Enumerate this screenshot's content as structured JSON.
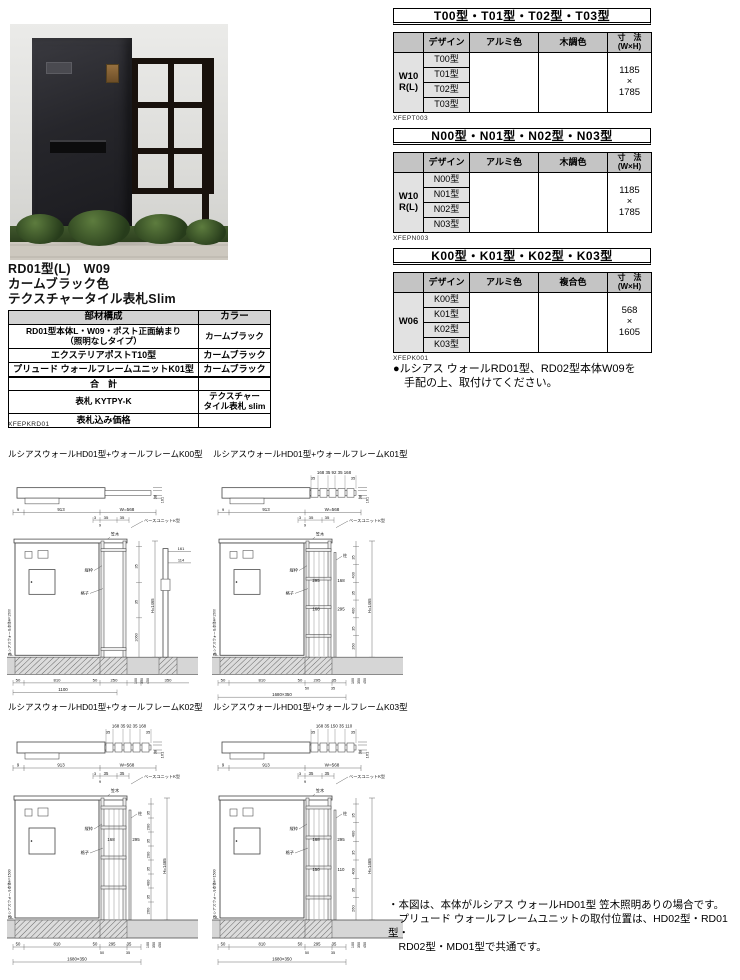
{
  "product": {
    "title_lines": [
      "RD01型(L)　W09",
      "カームブラック色",
      "テクスチャータイル表札Slim"
    ],
    "code": "XFEPKRD01",
    "spec_table": {
      "headers": [
        "部材構成",
        "カラー"
      ],
      "rows": [
        {
          "name": "RD01型本体L・W09・ポスト正面納まり\n（照明なしタイプ）",
          "color": "カームブラック"
        },
        {
          "name": "エクステリアポストT10型",
          "color": "カームブラック"
        },
        {
          "name": "プリュード ウォールフレームユニットK01型",
          "color": "カームブラック"
        },
        {
          "name": "合　計",
          "color": ""
        },
        {
          "name": "表札 KYTPY-K",
          "color": "テクスチャー\nタイル表札 slim"
        },
        {
          "name": "表札込み価格",
          "color": ""
        }
      ]
    }
  },
  "series_tables": [
    {
      "title": "T00型・T01型・T02型・T03型",
      "code": "XFEPT003",
      "design_header": "デザイン",
      "col2": "アルミ色",
      "col3": "木調色",
      "size_header": "寸　法\n(W×H)",
      "stub": "W10\nR(L)",
      "designs": [
        "T00型",
        "T01型",
        "T02型",
        "T03型"
      ],
      "size": "1185\n×\n1785"
    },
    {
      "title": "N00型・N01型・N02型・N03型",
      "code": "XFEPN003",
      "design_header": "デザイン",
      "col2": "アルミ色",
      "col3": "木調色",
      "size_header": "寸　法\n(W×H)",
      "stub": "W10\nR(L)",
      "designs": [
        "N00型",
        "N01型",
        "N02型",
        "N03型"
      ],
      "size": "1185\n×\n1785"
    },
    {
      "title": "K00型・K01型・K02型・K03型",
      "code": "XFEPK001",
      "design_header": "デザイン",
      "col2": "アルミ色",
      "col3": "複合色",
      "size_header": "寸　法\n(W×H)",
      "stub": "W06",
      "designs": [
        "K00型",
        "K01型",
        "K02型",
        "K03型"
      ],
      "size": "568\n×\n1605"
    }
  ],
  "order_note_lines": [
    "●ルシアス ウォールRD01型、RD02型本体W09を",
    "　手配の上、取付けてください。"
  ],
  "bottom_note_lines": [
    "・本図は、本体がルシアス ウォールHD01型 笠木照明ありの場合です。",
    "　プリュード ウォールフレームユニットの取付位置は、HD02型・RD01型・",
    "　RD02型・MD01型で共通です。"
  ],
  "drawings": [
    {
      "title": "ルシアスウォールHD01型+ウォールフレームK00型",
      "plan": {
        "top_dims": "",
        "mid_dims": "",
        "side_dims": [
          "38",
          "161"
        ]
      },
      "labels": {
        "kasagi": "笠木",
        "tatewaku": "縦枠",
        "koshi": "格子",
        "unit": "ベースユニットK型",
        "gl": "GL",
        "wall": "ルシアスウォール本体H=1500"
      },
      "top_dims": [
        "9",
        "913",
        "W=568"
      ],
      "top_dims2": [
        "3",
        "35",
        "35",
        "9"
      ],
      "right_dims": [
        "35",
        "35",
        "1060"
      ],
      "h_dim": "H=1465",
      "mid_dims": [],
      "lower_right_dims": [
        "100",
        "350",
        "450"
      ],
      "bottom_dims": [
        "50",
        "810",
        "50",
        "250",
        "350"
      ],
      "bottom_dims2": [],
      "bottom_total": "1100",
      "post_dims": [
        "161",
        "114"
      ]
    },
    {
      "title": "ルシアスウォールHD01型+ウォールフレームK01型",
      "plan": {
        "top_dims": "168 35 92 35 168",
        "mid_dims": "35 35",
        "side_dims": [
          "38",
          "161"
        ]
      },
      "labels": {
        "kasagi": "笠木",
        "tatewaku": "縦枠",
        "koshi": "格子",
        "hashira": "柱",
        "unit": "ベースユニットK型",
        "gl": "GL",
        "wall": "ルシアスウォール本体H=1500"
      },
      "top_dims": [
        "9",
        "913",
        "W=568"
      ],
      "top_dims2": [
        "3",
        "35",
        "35",
        "9"
      ],
      "right_dims": [
        "35",
        "400",
        "35",
        "400",
        "35",
        "260"
      ],
      "h_dim": "H=1465",
      "mid_dims": [
        "295",
        "168",
        "168",
        "295"
      ],
      "lower_right_dims": [
        "100",
        "350",
        "450"
      ],
      "bottom_dims": [
        "50",
        "810",
        "50",
        "295",
        "35"
      ],
      "bottom_dims2": [
        "50",
        "35"
      ],
      "bottom_total": "1680×350",
      "post_dims": []
    },
    {
      "title": "ルシアスウォールHD01型+ウォールフレームK02型",
      "plan": {
        "top_dims": "168 35 92 35 168",
        "mid_dims": "35 35",
        "side_dims": [
          "38",
          "161"
        ]
      },
      "labels": {
        "kasagi": "笠木",
        "tatewaku": "縦枠",
        "koshi": "格子",
        "hashira": "柱",
        "unit": "ベースユニットK型",
        "gl": "GL",
        "wall": "ルシアスウォール本体H=1500"
      },
      "top_dims": [
        "9",
        "913",
        "W=568"
      ],
      "top_dims2": [
        "3",
        "35",
        "35",
        "9"
      ],
      "right_dims": [
        "35",
        "200",
        "35",
        "200",
        "35",
        "400",
        "35",
        "260"
      ],
      "h_dim": "H=1465",
      "mid_dims": [
        "168",
        "295"
      ],
      "lower_right_dims": [
        "100",
        "350",
        "450"
      ],
      "bottom_dims": [
        "50",
        "810",
        "50",
        "295",
        "35"
      ],
      "bottom_dims2": [
        "50",
        "35"
      ],
      "bottom_total": "1680×350",
      "post_dims": []
    },
    {
      "title": "ルシアスウォールHD01型+ウォールフレームK03型",
      "plan": {
        "top_dims": "168 35 150 35 110",
        "mid_dims": "35 35",
        "side_dims": [
          "38",
          "161"
        ]
      },
      "labels": {
        "kasagi": "笠木",
        "tatewaku": "縦枠",
        "koshi": "格子",
        "hashira": "柱",
        "unit": "ベースユニットK型",
        "gl": "GL",
        "wall": "ルシアスウォール本体H=1500"
      },
      "top_dims": [
        "9",
        "913",
        "W=568"
      ],
      "top_dims2": [
        "3",
        "35",
        "35",
        "9"
      ],
      "right_dims": [
        "35",
        "400",
        "35",
        "400",
        "35",
        "260"
      ],
      "h_dim": "H=1465",
      "mid_dims": [
        "168",
        "295",
        "150",
        "110"
      ],
      "lower_right_dims": [
        "100",
        "350",
        "450"
      ],
      "bottom_dims": [
        "50",
        "810",
        "50",
        "295",
        "35"
      ],
      "bottom_dims2": [
        "50",
        "35"
      ],
      "bottom_total": "1680×350",
      "post_dims": []
    }
  ]
}
